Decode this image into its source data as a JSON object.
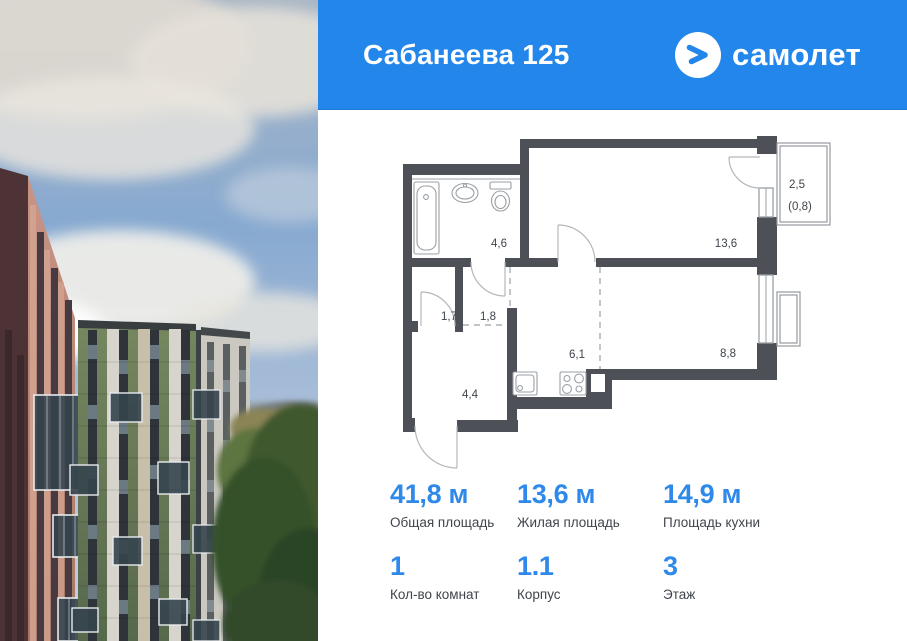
{
  "header": {
    "title": "Сабанеева 125",
    "brand": "самолет",
    "background_color": "#2286ea"
  },
  "plan": {
    "labels": {
      "bathroom": "4,6",
      "living_room": "13,6",
      "hallway_small": "1,7",
      "hallway": "1,8",
      "kitchen": "6,1",
      "room": "8,8",
      "entry": "4,4",
      "balcony": "2,5",
      "balcony_reduced": "(0,8)"
    }
  },
  "stats": {
    "accent_color": "#2e89ea",
    "primary": [
      {
        "value": "41,8 м",
        "label": "Общая площадь"
      },
      {
        "value": "13,6 м",
        "label": "Жилая площадь"
      },
      {
        "value": "14,9 м",
        "label": "Площадь кухни"
      }
    ],
    "secondary": [
      {
        "value": "1",
        "label": "Кол-во комнат"
      },
      {
        "value": "1.1",
        "label": "Корпус"
      },
      {
        "value": "3",
        "label": "Этаж"
      }
    ]
  }
}
